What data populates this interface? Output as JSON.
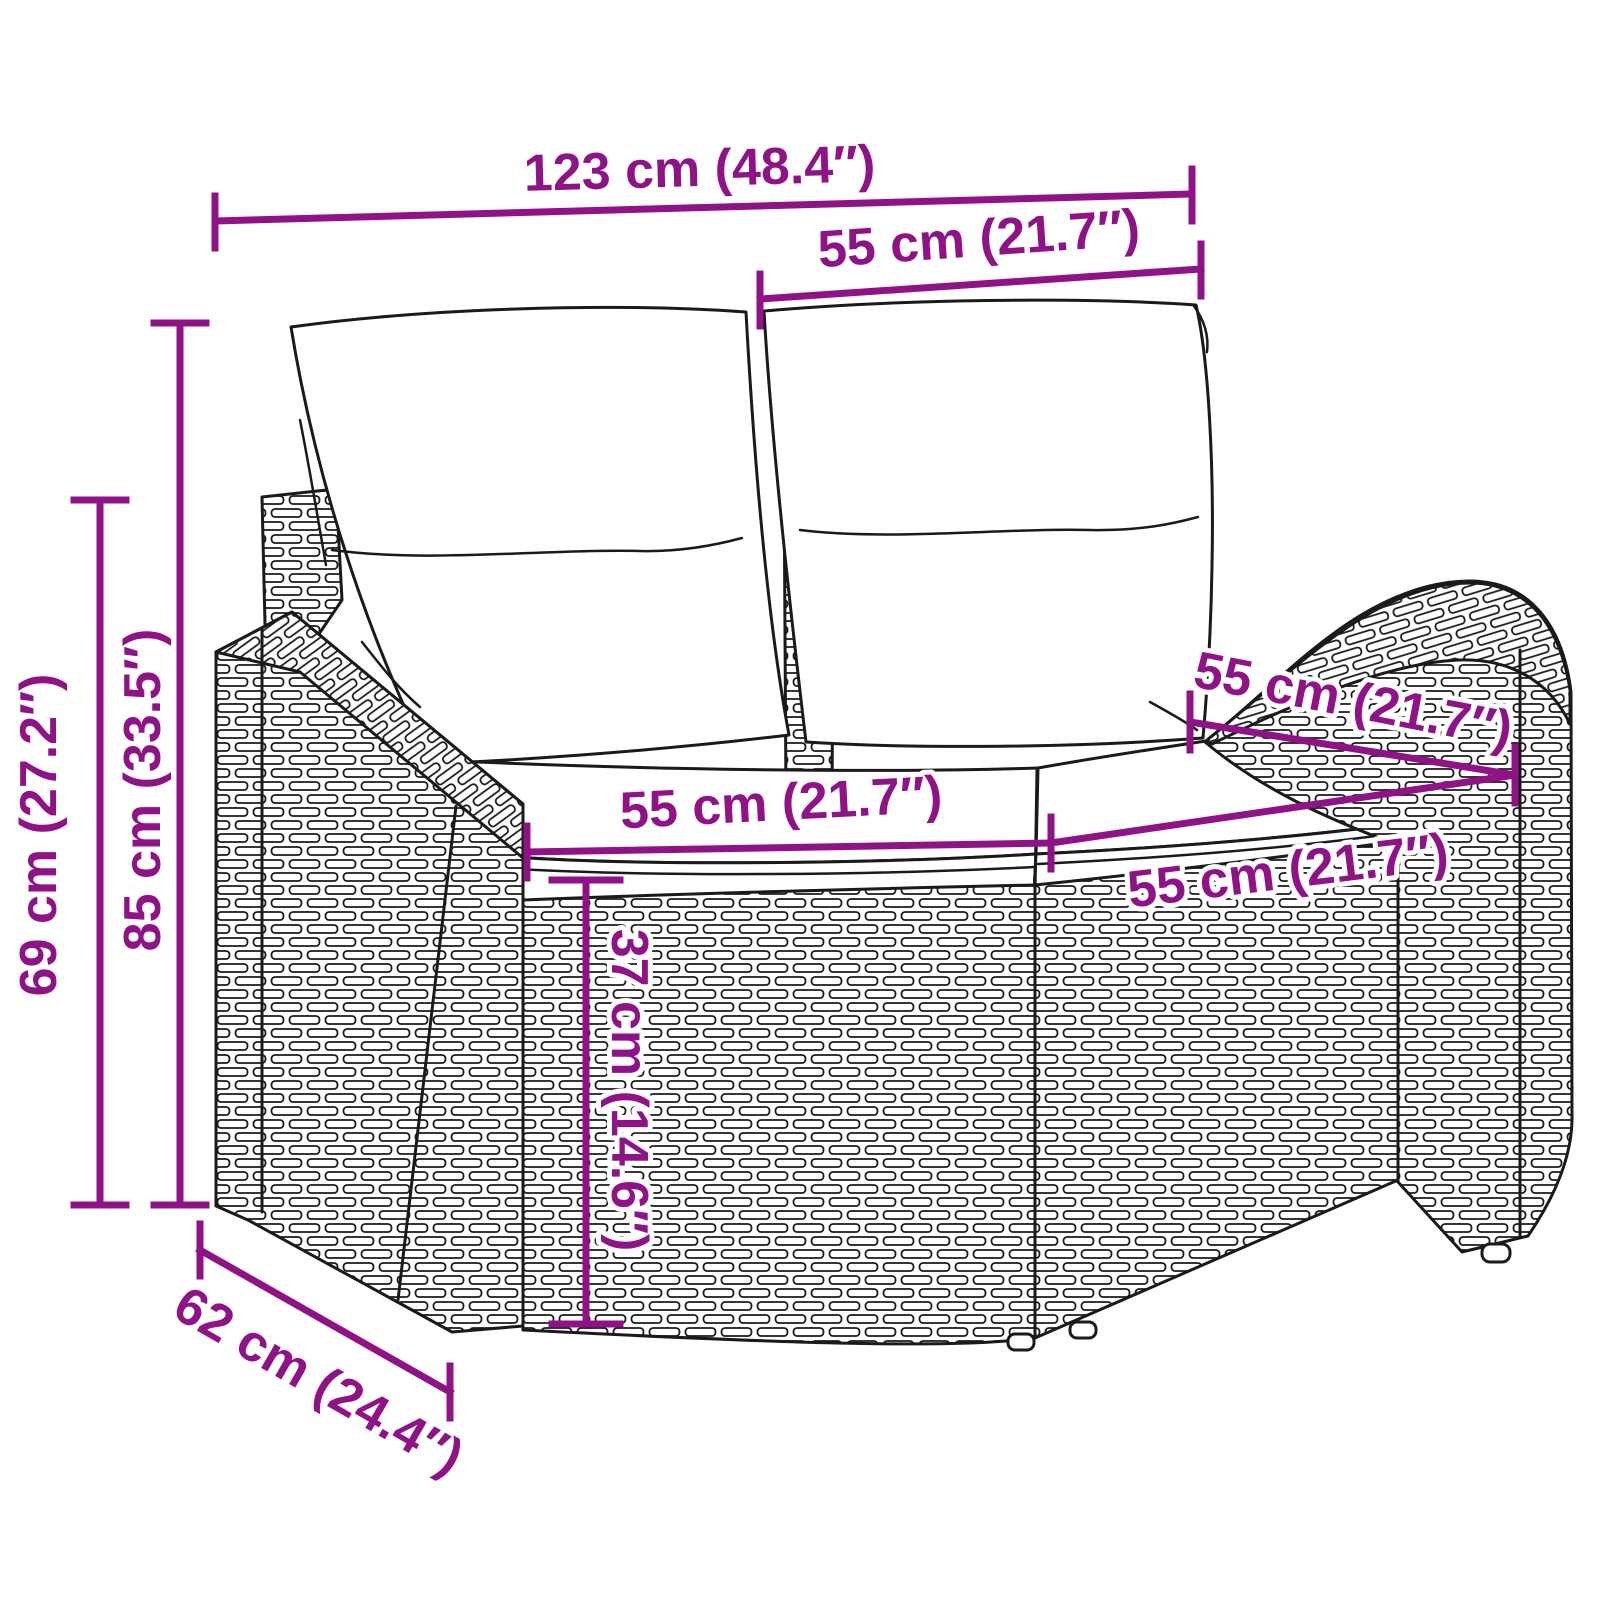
{
  "colors": {
    "accent": "#8F1386",
    "ink": "#1a1a1a",
    "background": "#FFFFFF"
  },
  "diagram": {
    "kind": "furniture-dimension-diagram",
    "subject": "poly rattan 2-seater garden sofa with back and seat cushions",
    "dimensions": {
      "overall_width": "123 cm (48.4″)",
      "back_cushion_width": "55 cm (21.7″)",
      "overall_height": "85 cm (33.5″)",
      "arm_height": "69 cm (27.2″)",
      "left_seat_width": "55 cm (21.7″)",
      "right_seat_width": "55 cm (21.7″)",
      "seat_depth": "55 cm (21.7″)",
      "seat_height": "37 cm (14.6″)",
      "overall_depth": "62 cm (24.4″)"
    }
  }
}
